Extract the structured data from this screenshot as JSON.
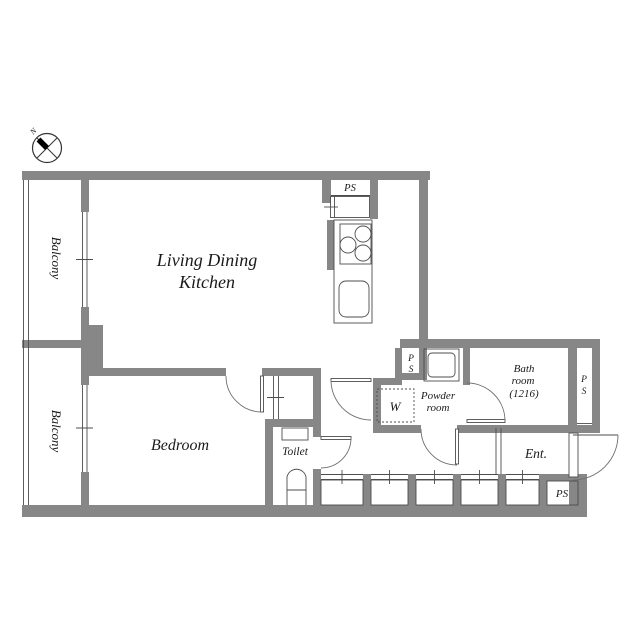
{
  "compass": {
    "north": "N"
  },
  "rooms": {
    "ldk": {
      "line1": "Living Dining",
      "line2": "Kitchen"
    },
    "bedroom": {
      "label": "Bedroom"
    },
    "balcony_upper": {
      "label": "Balcony"
    },
    "balcony_lower": {
      "label": "Balcony"
    },
    "toilet": {
      "label": "Toilet"
    },
    "powder": {
      "line1": "Powder",
      "line2": "room"
    },
    "bath": {
      "line1": "Bath",
      "line2": "room",
      "line3": "(1216)"
    },
    "entrance": {
      "label": "Ent."
    },
    "washer": {
      "label": "W"
    }
  },
  "pipe_spaces": {
    "kitchen": "PS",
    "mid_p": "P",
    "mid_s": "S",
    "right_p": "P",
    "right_s": "S",
    "bottom": "PS"
  },
  "colors": {
    "wall": "#878787",
    "line": "#4d4d4d",
    "text": "#1a1a1a",
    "background": "#ffffff"
  }
}
